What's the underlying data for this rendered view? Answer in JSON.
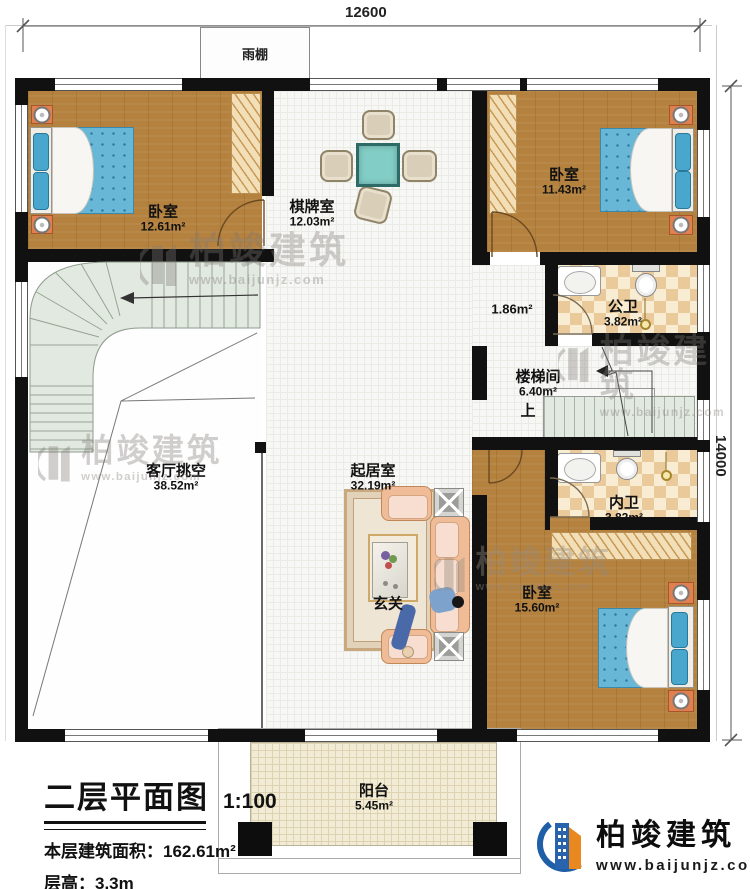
{
  "dimensions": {
    "top": "12600",
    "right": "14000"
  },
  "canopy": {
    "label": "雨棚"
  },
  "rooms": {
    "bedroom1": {
      "name": "卧室",
      "area": "12.61m²"
    },
    "chess": {
      "name": "棋牌室",
      "area": "12.03m²"
    },
    "bedroom2": {
      "name": "卧室",
      "area": "11.43m²"
    },
    "corridor": {
      "area": "1.86m²"
    },
    "public_bath": {
      "name": "公卫",
      "area": "3.82m²"
    },
    "stair_hall": {
      "name": "楼梯间",
      "area": "6.40m²",
      "up": "上"
    },
    "void": {
      "name": "客厅挑空",
      "area": "38.52m²"
    },
    "living": {
      "name": "起居室",
      "area": "32.19m²"
    },
    "entry": {
      "name": "玄关"
    },
    "inner_bath": {
      "name": "内卫",
      "area": "3.82m²"
    },
    "bedroom3": {
      "name": "卧室",
      "area": "15.60m²"
    },
    "balcony": {
      "name": "阳台",
      "area": "5.45m²"
    }
  },
  "title_block": {
    "title": "二层平面图",
    "scale": "1:100",
    "area_label": "本层建筑面积：",
    "area_value": "162.61m²",
    "floor_height_label": "层高：",
    "floor_height_value": "3.3m"
  },
  "brand": {
    "name": "柏竣建筑",
    "url": "www.baijunjz.com"
  },
  "watermark": {
    "name": "柏竣建筑",
    "url": "www.baijunjz.com"
  },
  "colors": {
    "wall": "#111111",
    "wood": "#b4813e",
    "checker": "#eac99b",
    "stair": "#e2e9e0",
    "mattress": "#68b7d7",
    "brand_blue": "#2864ae",
    "brand_orange": "#e8881f"
  }
}
